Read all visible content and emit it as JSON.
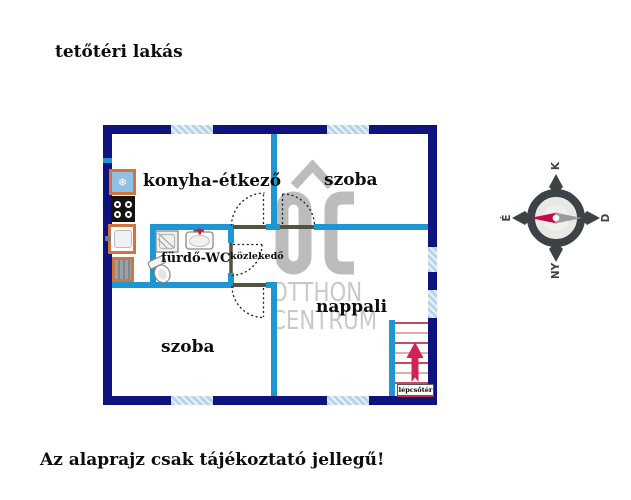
{
  "page": {
    "title": "tetőtéri lakás",
    "disclaimer": "Az alaprajz csak tájékoztató jellegű!"
  },
  "rooms": {
    "kitchen_dining": "konyha-étkező",
    "room_top": "szoba",
    "bathroom": "fürdő-WC",
    "hallway": "közlekedő",
    "living_room": "nappali",
    "room_bottom": "szoba",
    "stairwell": "lépcsőtér"
  },
  "watermark": {
    "logo": "OC",
    "line1": "OTTHON",
    "line2": "CENTRUM"
  },
  "compass": {
    "east": "K",
    "north": "É",
    "south": "D",
    "west": "NY"
  },
  "icons": {
    "fridge_glyph": "❄"
  },
  "colors": {
    "outer_wall": "#10127e",
    "inner_wall": "#1e96d2",
    "window_fill": "#b9d2e8",
    "appliance_orange": "#d2753c",
    "fridge_blue": "#8fc0e8",
    "stair_red": "#c64b5c",
    "stair_red_light": "#e4aab4",
    "arrow_crimson": "#ce2354",
    "watermark_gray": "#bcbcbc",
    "compass_dark": "#3d4247",
    "needle_red": "#c30b4e"
  }
}
